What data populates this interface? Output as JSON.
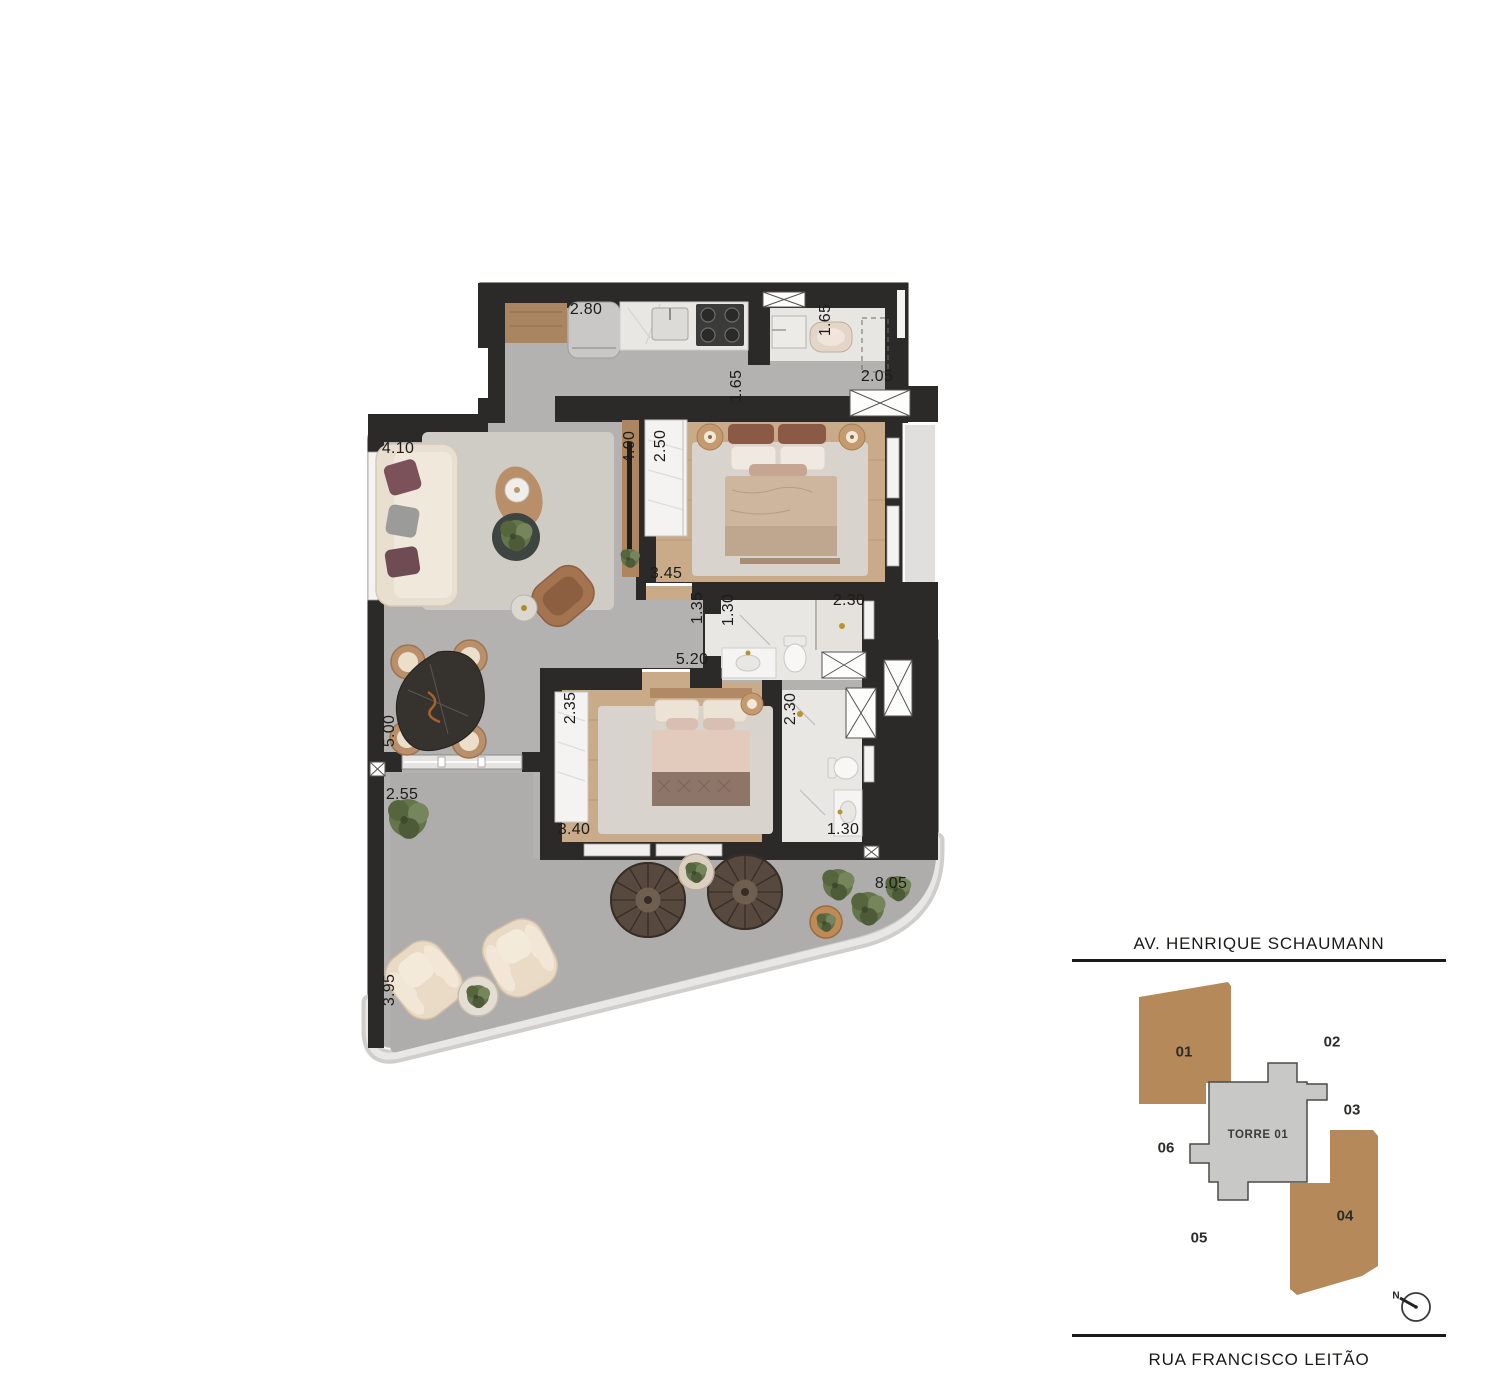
{
  "floor_plan": {
    "dimensions": [
      {
        "t": "2.80",
        "x": 586,
        "y": 310,
        "r": 0
      },
      {
        "t": "1.65",
        "x": 826,
        "y": 320,
        "r": -90
      },
      {
        "t": "2.05",
        "x": 877,
        "y": 377,
        "r": 0
      },
      {
        "t": "1.65",
        "x": 737,
        "y": 386,
        "r": -90
      },
      {
        "t": "4.10",
        "x": 398,
        "y": 449,
        "r": 0
      },
      {
        "t": "4.00",
        "x": 630,
        "y": 447,
        "r": -90
      },
      {
        "t": "2.50",
        "x": 661,
        "y": 446,
        "r": -90
      },
      {
        "t": "3.45",
        "x": 666,
        "y": 574,
        "r": 0
      },
      {
        "t": "1.35",
        "x": 698,
        "y": 608,
        "r": -90
      },
      {
        "t": "1.30",
        "x": 729,
        "y": 610,
        "r": -90
      },
      {
        "t": "2.30",
        "x": 849,
        "y": 601,
        "r": 0
      },
      {
        "t": "5.20",
        "x": 692,
        "y": 660,
        "r": 0
      },
      {
        "t": "2.35",
        "x": 571,
        "y": 708,
        "r": -90
      },
      {
        "t": "2.30",
        "x": 791,
        "y": 709,
        "r": -90
      },
      {
        "t": "5.00",
        "x": 390,
        "y": 731,
        "r": -90
      },
      {
        "t": "2.55",
        "x": 402,
        "y": 795,
        "r": 0
      },
      {
        "t": "3.40",
        "x": 574,
        "y": 830,
        "r": 0
      },
      {
        "t": "1.30",
        "x": 843,
        "y": 830,
        "r": 0
      },
      {
        "t": "8.05",
        "x": 891,
        "y": 884,
        "r": 0
      },
      {
        "t": "3.95",
        "x": 390,
        "y": 990,
        "r": -90
      }
    ]
  },
  "key_plan": {
    "street_top": "AV. HENRIQUE SCHAUMANN",
    "street_bottom": "RUA FRANCISCO LEITÃO",
    "tower_label": "TORRE 01",
    "north_label": "N",
    "highlight_color": "#b6895a",
    "units": [
      {
        "id": "01",
        "x": 1184,
        "y": 1052,
        "highlighted": true
      },
      {
        "id": "02",
        "x": 1332,
        "y": 1042,
        "highlighted": false
      },
      {
        "id": "03",
        "x": 1352,
        "y": 1110,
        "highlighted": false
      },
      {
        "id": "04",
        "x": 1345,
        "y": 1216,
        "highlighted": true
      },
      {
        "id": "05",
        "x": 1199,
        "y": 1238,
        "highlighted": false
      },
      {
        "id": "06",
        "x": 1166,
        "y": 1148,
        "highlighted": false
      }
    ]
  },
  "colors": {
    "wall": "#2b2a28",
    "floor_gray": "#b3b2b0",
    "terrace_gray": "#aeadab",
    "wood": "#c9ab8a",
    "marble": "#e9e7e4",
    "unit_highlight": "#b6895a"
  }
}
